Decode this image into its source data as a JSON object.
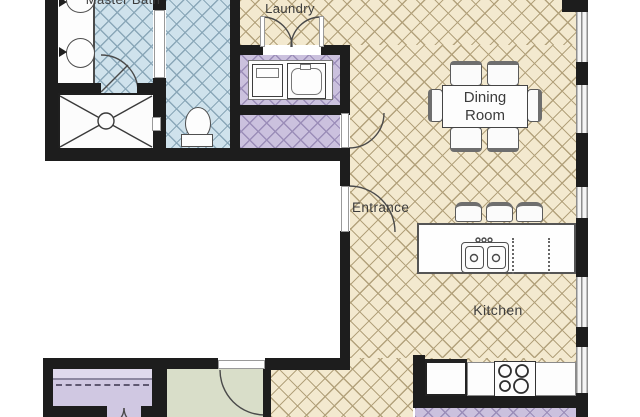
{
  "floorplan": {
    "rooms": {
      "master_bath": {
        "label": "Master Bath"
      },
      "laundry": {
        "label": "Laundry"
      },
      "dining_room": {
        "label": "Dining Room"
      },
      "entrance": {
        "label": "Entrance"
      },
      "kitchen": {
        "label": "Kitchen"
      }
    },
    "colors": {
      "wall": "#1d1d1d",
      "floor_living": "#f3e9cf",
      "hatch_living": "#b3a27c",
      "floor_bath": "#cfe2ec",
      "hatch_bath": "#8aa7b8",
      "floor_purple": "#cbc1de",
      "hatch_purple": "#9b8db8",
      "floor_closet": "#d0c8e2",
      "closet_shelf": "#dfd9ec",
      "floor_green": "#d9dec9",
      "fixture_line": "#4f4f4f",
      "label_color": "#3c3c3c"
    },
    "fixtures": [
      "double-vanity-sinks",
      "walk-in-shower",
      "toilet",
      "pocket-door",
      "washer",
      "dryer",
      "laundry-double-doors",
      "dining-table",
      "dining-chairs",
      "kitchen-island",
      "island-double-sink",
      "dishwasher",
      "bar-stools",
      "refrigerator",
      "cooktop",
      "kitchen-counter",
      "closet-shelf-and-rod",
      "entrance-door",
      "interior-doors",
      "windows"
    ]
  }
}
